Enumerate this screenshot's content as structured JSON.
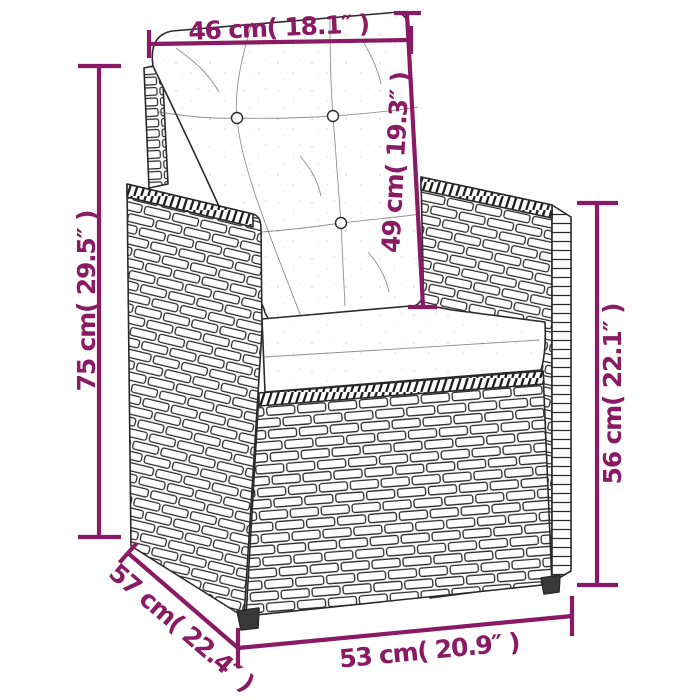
{
  "colors": {
    "accent": "#8A1A64",
    "line": "#2a2a2a",
    "background": "#ffffff"
  },
  "dimensions": {
    "top_width": "46 cm( 18.1″ )",
    "backrest_height": "49 cm( 19.3″ )",
    "overall_height": "75 cm( 29.5″ )",
    "armrest_height": "56 cm( 22.1″ )",
    "depth": "57 cm( 22.4″ )",
    "bottom_width": "53 cm( 20.9″ )"
  }
}
